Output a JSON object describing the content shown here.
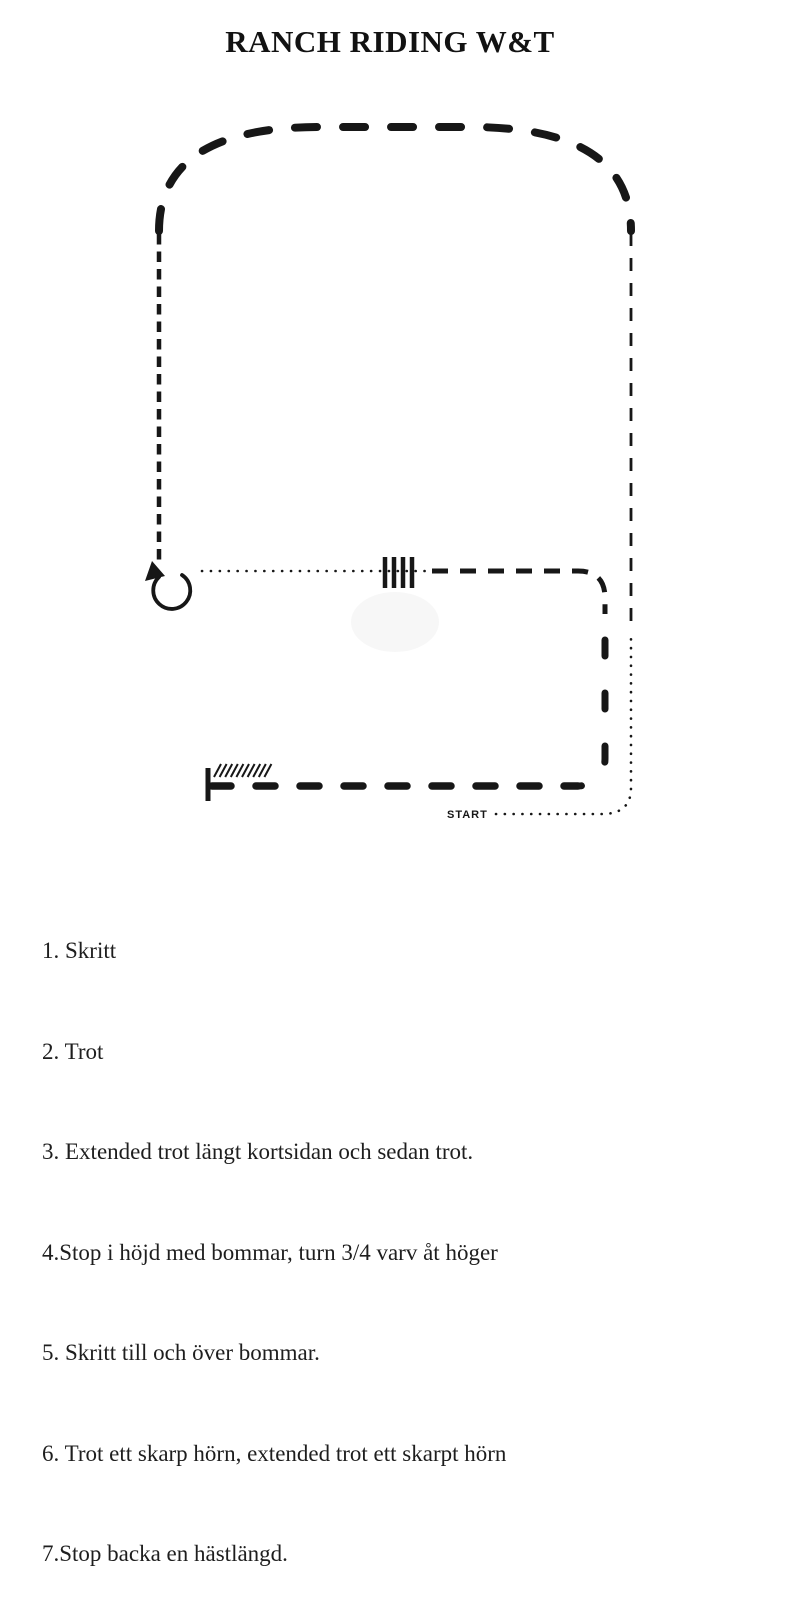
{
  "page": {
    "title": "RANCH RIDING W&T",
    "background_color": "#ffffff",
    "ink_color": "#171717",
    "smudge_color": "#f1f1f1"
  },
  "diagram": {
    "start_label": "START",
    "ground_pole_count": 4
  },
  "instructions": [
    "1. Skritt",
    "2. Trot",
    "3. Extended trot längt kortsidan och sedan trot.",
    "4.Stop i höjd med bommar, turn 3/4 varv åt höger",
    "5. Skritt till och över bommar.",
    "6. Trot ett skarp hörn, extended trot ett skarpt hörn",
    "7.Stop backa en hästlängd."
  ]
}
